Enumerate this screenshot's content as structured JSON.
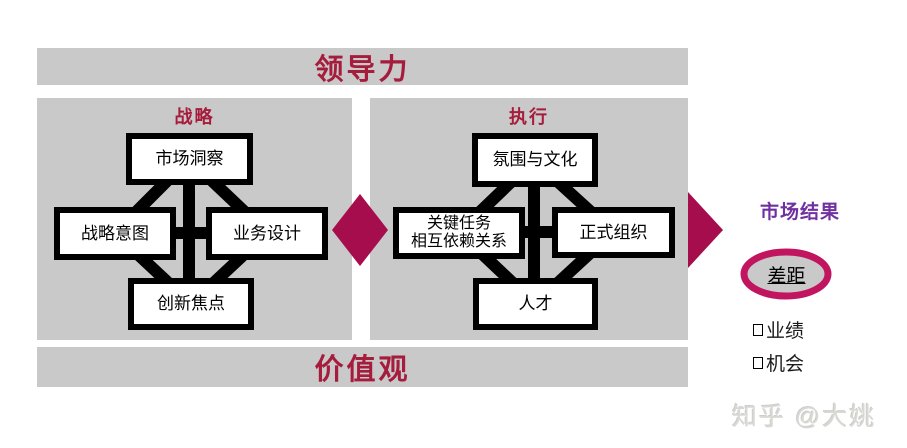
{
  "colors": {
    "panel_gray": "#C9C9C9",
    "heading_red": "#A51C3C",
    "accent_magenta": "#A50D4C",
    "ellipse_ring": "#C2155F",
    "results_purple": "#7030A0",
    "box_border": "#000000",
    "box_fill": "#FFFFFF"
  },
  "top_bar": {
    "label": "领导力"
  },
  "bottom_bar": {
    "label": "价值观"
  },
  "strategy_panel": {
    "title": "战略",
    "boxes": {
      "top": "市场洞察",
      "left": "战略意图",
      "right": "业务设计",
      "bottom": "创新焦点"
    }
  },
  "execution_panel": {
    "title": "执行",
    "boxes": {
      "top": "氛围与文化",
      "left_line1": "关键任务",
      "left_line2": "相互依赖关系",
      "right": "正式组织",
      "bottom": "人才"
    }
  },
  "results": {
    "title": "市场结果",
    "gap_label": "差距",
    "items": [
      {
        "label": "业绩"
      },
      {
        "label": "机会"
      }
    ]
  },
  "watermark": "知乎 @大姚"
}
